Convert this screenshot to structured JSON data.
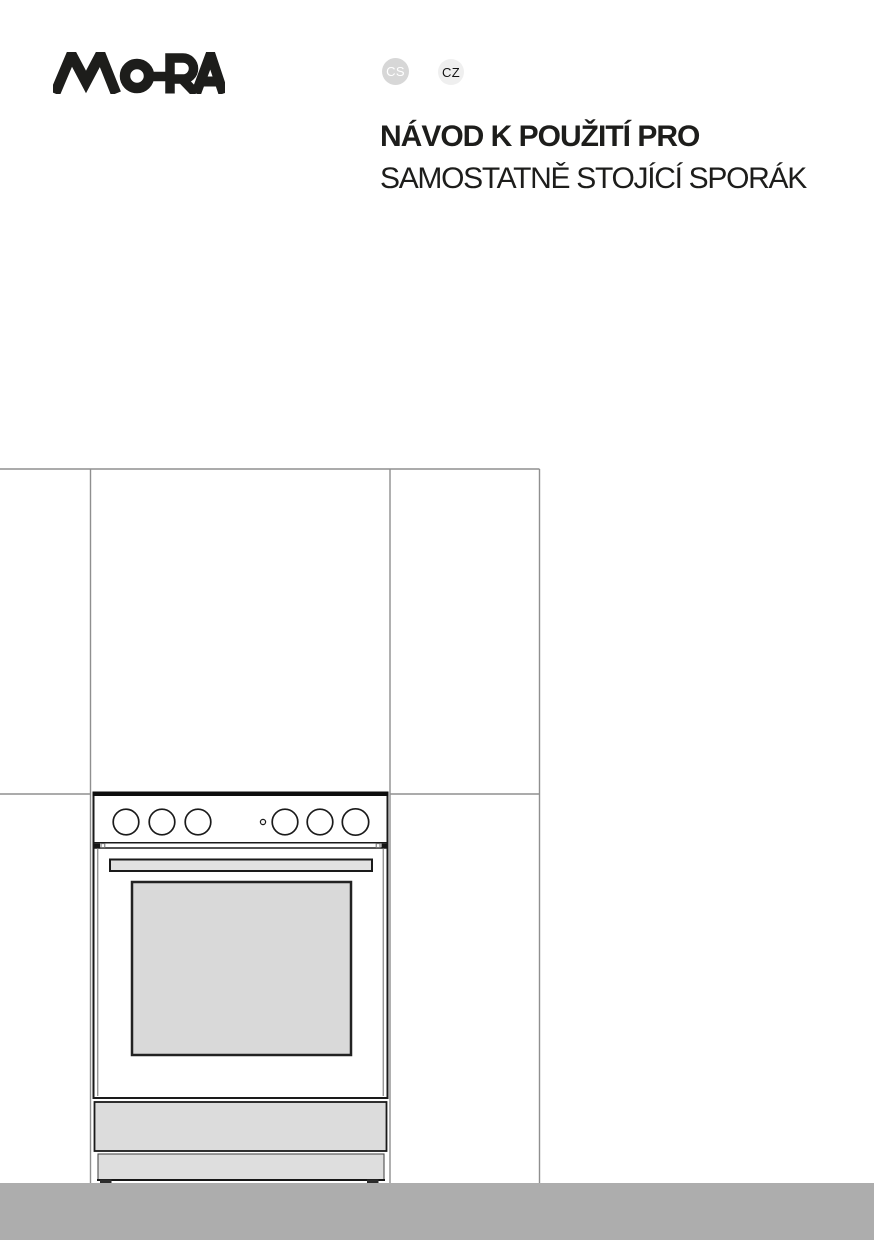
{
  "header": {
    "brand": "MORA",
    "language_badges": [
      {
        "code": "CS"
      },
      {
        "code": "CZ"
      }
    ]
  },
  "title": {
    "line1": "NÁVOD K POUŽITÍ PRO",
    "line2": "SAMOSTATNĚ STOJÍCÍ SPORÁK"
  },
  "colors": {
    "ink": "#1d1d1b",
    "wall-line": "#8f8f8f",
    "appliance-fill": "#dcdcdc",
    "appliance-outline": "#1a1a1a",
    "hob-bar": "#0e0e0e",
    "glass-fill": "#d9d9d9",
    "handle-fill": "#e2e2e2",
    "footer-gray": "#adadad",
    "badge-cs-bg": "#d7d7d7",
    "badge-cs-text": "#ffffff",
    "badge-cz-bg": "#efefef",
    "badge-cz-text": "#111111"
  }
}
